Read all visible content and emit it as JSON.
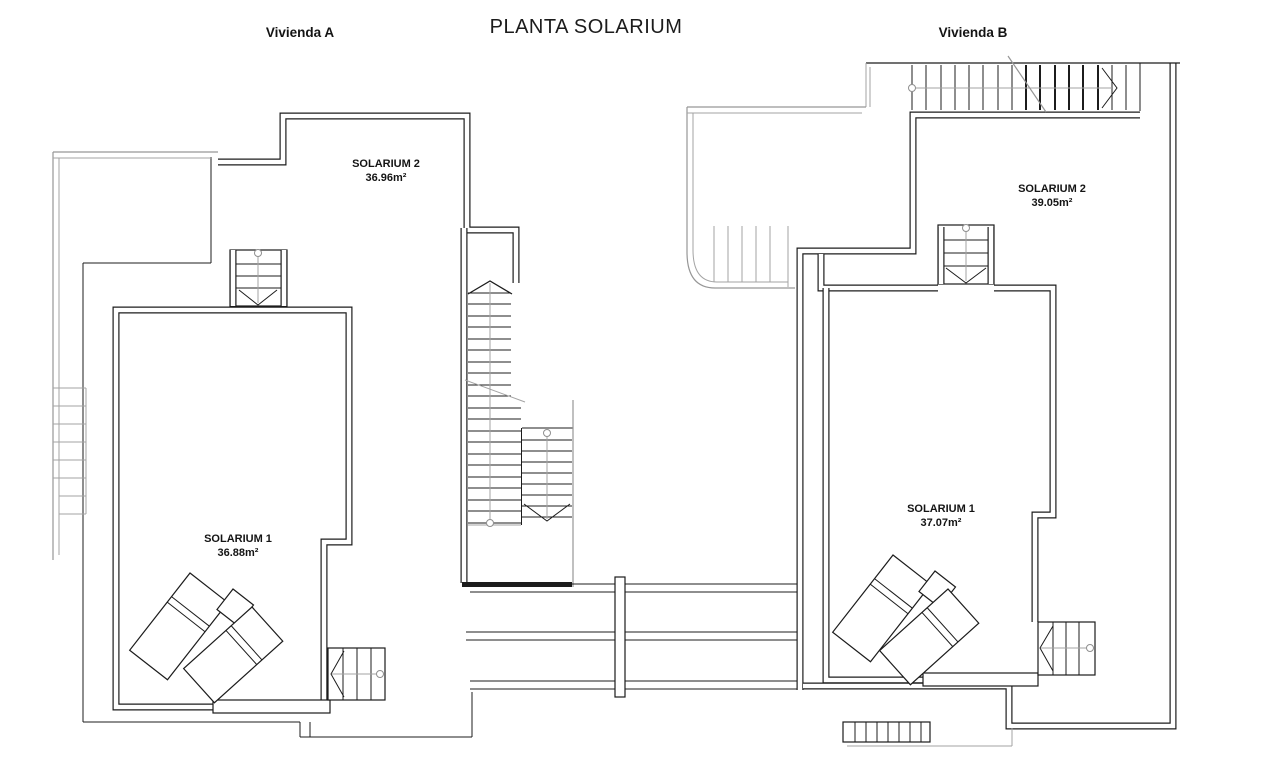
{
  "title": "PLANTA SOLARIUM",
  "vivienda_a": {
    "label": "Vivienda A",
    "solarium2": {
      "name": "SOLARIUM 2",
      "area": "36.96m²"
    },
    "solarium1": {
      "name": "SOLARIUM 1",
      "area": "36.88m²"
    }
  },
  "vivienda_b": {
    "label": "Vivienda B",
    "solarium2": {
      "name": "SOLARIUM 2",
      "area": "39.05m²"
    },
    "solarium1": {
      "name": "SOLARIUM 1",
      "area": "37.07m²"
    }
  },
  "colors": {
    "line": "#1c1c1c",
    "secondary_line": "#969696",
    "background": "#ffffff"
  }
}
